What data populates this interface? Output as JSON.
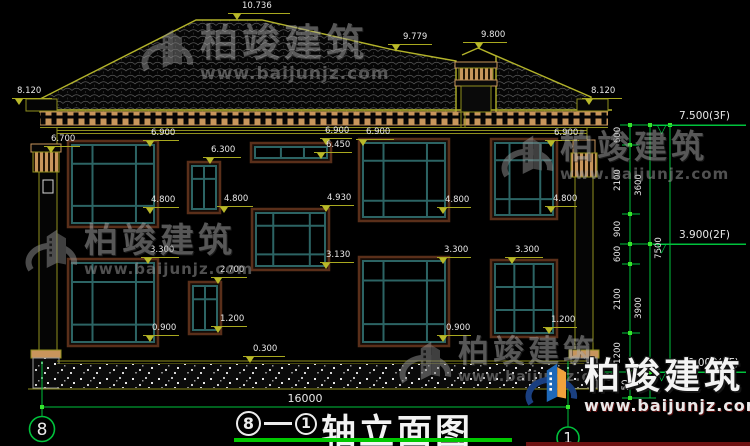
{
  "watermark": {
    "brand": "柏竣建筑",
    "url": "www.baijunjz.com"
  },
  "title_block": {
    "axis_left": "8",
    "separator": "—",
    "axis_right": "1",
    "title": "轴立面图"
  },
  "axes": {
    "left_bubble": "8",
    "right_bubble": "1"
  },
  "bottom_dimension": "16000",
  "annotations": {
    "flags": [
      {
        "t": "10.736",
        "x": 228,
        "y": 13,
        "w": 62,
        "tp": 5,
        "tl": 14
      },
      {
        "t": "9.779",
        "x": 388,
        "y": 44,
        "w": 44,
        "tp": 4,
        "tl": 15
      },
      {
        "t": "9.800",
        "x": 463,
        "y": 42,
        "w": 44,
        "tp": 12,
        "tl": 18
      },
      {
        "t": "8.120",
        "x": 12,
        "y": 98,
        "w": 40,
        "tp": 3,
        "tl": 5
      },
      {
        "t": "8.120",
        "x": 582,
        "y": 98,
        "w": 40,
        "tp": 3,
        "tl": 9
      },
      {
        "t": "6.700",
        "x": 44,
        "y": 146,
        "w": 36,
        "tp": 3,
        "tl": 7
      },
      {
        "t": "6.900",
        "x": 143,
        "y": 140,
        "w": 36,
        "tp": 3,
        "tl": 8
      },
      {
        "t": "4.800",
        "x": 143,
        "y": 207,
        "w": 36,
        "tp": 3,
        "tl": 8
      },
      {
        "t": "6.300",
        "x": 203,
        "y": 157,
        "w": 38,
        "tp": 3,
        "tl": 8
      },
      {
        "t": "4.800",
        "x": 217,
        "y": 206,
        "w": 36,
        "tp": 3,
        "tl": 7
      },
      {
        "t": "6.900",
        "x": 320,
        "y": 138,
        "w": 32,
        "tp": 2,
        "tl": 5
      },
      {
        "t": "6.450",
        "x": 314,
        "y": 152,
        "w": 38,
        "tp": 3,
        "tl": 12
      },
      {
        "t": "4.930",
        "x": 320,
        "y": 205,
        "w": 34,
        "tp": 2,
        "tl": 7
      },
      {
        "t": "3.130",
        "x": 320,
        "y": 262,
        "w": 34,
        "tp": 2,
        "tl": 6
      },
      {
        "t": "6.900",
        "x": 356,
        "y": 139,
        "w": 38,
        "tp": 3,
        "tl": 10
      },
      {
        "t": "4.800",
        "x": 437,
        "y": 207,
        "w": 34,
        "tp": 2,
        "tl": 8
      },
      {
        "t": "6.900",
        "x": 545,
        "y": 140,
        "w": 34,
        "tp": 2,
        "tl": 9
      },
      {
        "t": "4.800",
        "x": 545,
        "y": 206,
        "w": 32,
        "tp": 2,
        "tl": 8
      },
      {
        "t": "3.300",
        "x": 141,
        "y": 257,
        "w": 38,
        "tp": 3,
        "tl": 9
      },
      {
        "t": "0.900",
        "x": 143,
        "y": 335,
        "w": 36,
        "tp": 3,
        "tl": 9
      },
      {
        "t": "2.700",
        "x": 211,
        "y": 277,
        "w": 36,
        "tp": 3,
        "tl": 9
      },
      {
        "t": "1.200",
        "x": 211,
        "y": 326,
        "w": 36,
        "tp": 3,
        "tl": 9
      },
      {
        "t": "3.300",
        "x": 437,
        "y": 257,
        "w": 34,
        "tp": 2,
        "tl": 7
      },
      {
        "t": "0.900",
        "x": 437,
        "y": 335,
        "w": 34,
        "tp": 2,
        "tl": 9
      },
      {
        "t": "3.300",
        "x": 505,
        "y": 257,
        "w": 38,
        "tp": 3,
        "tl": 10
      },
      {
        "t": "1.200",
        "x": 543,
        "y": 327,
        "w": 34,
        "tp": 2,
        "tl": 8
      },
      {
        "t": "0.300",
        "x": 243,
        "y": 356,
        "w": 42,
        "tp": 3,
        "tl": 10
      }
    ],
    "level_flags": [
      {
        "t": "7.500(3F)",
        "x": 653,
        "y": 125,
        "w": 93
      },
      {
        "t": "3.900(2F)",
        "x": 653,
        "y": 244,
        "w": 93
      },
      {
        "t": "±0.000(1F)",
        "x": 653,
        "y": 372,
        "w": 93
      }
    ],
    "vertical_texts": [
      {
        "t": "600",
        "x": 618,
        "y": 135
      },
      {
        "t": "2100",
        "x": 618,
        "y": 180
      },
      {
        "t": "900",
        "x": 618,
        "y": 229
      },
      {
        "t": "600",
        "x": 618,
        "y": 254
      },
      {
        "t": "2100",
        "x": 618,
        "y": 299
      },
      {
        "t": "1200",
        "x": 618,
        "y": 353
      },
      {
        "t": "50",
        "x": 626,
        "y": 385
      },
      {
        "t": "3600",
        "x": 639,
        "y": 185
      },
      {
        "t": "3900",
        "x": 639,
        "y": 308
      },
      {
        "t": "7500",
        "x": 659,
        "y": 248
      }
    ]
  },
  "geometry": {
    "windows": [
      {
        "x": 68,
        "y": 141,
        "w": 90,
        "h": 86,
        "type": "A"
      },
      {
        "x": 188,
        "y": 162,
        "w": 32,
        "h": 51,
        "type": "B"
      },
      {
        "x": 251,
        "y": 143,
        "w": 80,
        "h": 19,
        "type": "S"
      },
      {
        "x": 252,
        "y": 209,
        "w": 77,
        "h": 61,
        "type": "A"
      },
      {
        "x": 359,
        "y": 139,
        "w": 90,
        "h": 82,
        "type": "A"
      },
      {
        "x": 491,
        "y": 139,
        "w": 66,
        "h": 80,
        "type": "A"
      },
      {
        "x": 68,
        "y": 259,
        "w": 90,
        "h": 87,
        "type": "A"
      },
      {
        "x": 189,
        "y": 282,
        "w": 32,
        "h": 52,
        "type": "B"
      },
      {
        "x": 359,
        "y": 257,
        "w": 90,
        "h": 89,
        "type": "A"
      },
      {
        "x": 491,
        "y": 260,
        "w": 66,
        "h": 77,
        "type": "G"
      }
    ],
    "watermark_instances": [
      {
        "x": 140,
        "y": 24,
        "s": 1.05,
        "variant": "gray"
      },
      {
        "x": 500,
        "y": 130,
        "s": 0.92,
        "variant": "gray"
      },
      {
        "x": 24,
        "y": 224,
        "s": 0.95,
        "variant": "gray"
      },
      {
        "x": 398,
        "y": 336,
        "s": 0.85,
        "variant": "gray"
      },
      {
        "x": 524,
        "y": 358,
        "s": 1.0,
        "variant": "color"
      }
    ]
  },
  "colors": {
    "cad_line": "#8f8f1e",
    "dim_line": "#a9a91f",
    "green": "#00c23c",
    "tan": "#c8955c",
    "window_trim": "#5a2f1a",
    "window_frame": "#2c6464",
    "text": "#e8e8e8",
    "title_underline": "#00c800"
  }
}
